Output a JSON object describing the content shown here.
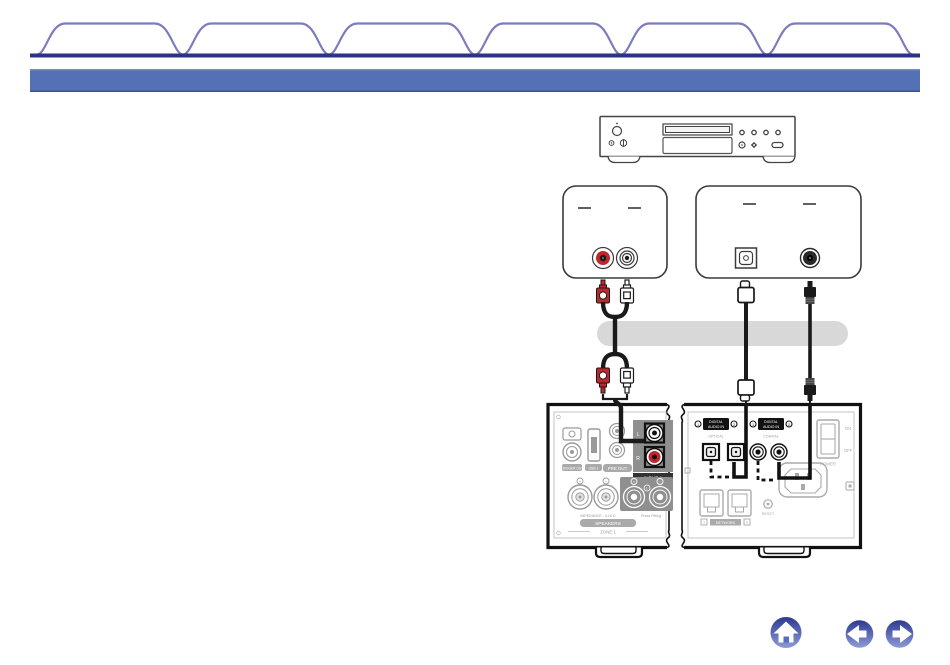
{
  "window": {
    "width": 950,
    "height": 665,
    "background": "#ffffff"
  },
  "tab_bar": {
    "outline_color": "#7b7bbd",
    "baseline_color": "#2b3383",
    "tabs": [
      {
        "label": ""
      },
      {
        "label": ""
      },
      {
        "label": ""
      },
      {
        "label": ""
      },
      {
        "label": ""
      },
      {
        "label": ""
      }
    ]
  },
  "title_bar": {
    "text": "",
    "background": "#5571b5"
  },
  "diagram": {
    "colors": {
      "line_art": "#3a3a3a",
      "deemphasized_gray": "#9a9a9a",
      "cable_black": "#1a1a1a",
      "rca_red": "#c0272d",
      "callout_pill_gray": "#d8d8d8",
      "highlight_black": "#111111"
    },
    "labels": {
      "pre_out": "PRE OUT",
      "input1": "INPUT 1",
      "jack_l": "L",
      "jack_r": "R",
      "trigger": "TRIGGER OUT",
      "usb": "USB 1",
      "impedance": "IMPEDANCE : 4-16 Ω",
      "fitting": "Press Fitting",
      "speakers": "SPEAKERS",
      "zone": "ZONE 1",
      "plus": "+",
      "minus": "−",
      "digital_badge_line1": "DIGITAL",
      "digital_badge_line2": "AUDIO IN",
      "optical_sub": "OPTICAL",
      "coaxial_sub": "COAXIAL",
      "n1": "1",
      "n2": "2",
      "network": "NETWORK",
      "reset": "RESET",
      "power_on": "ON",
      "power_off": "OFF",
      "power": "POWER"
    }
  },
  "nav": {
    "gradient_top": "#2c3a90",
    "gradient_bottom": "#8e9bd8",
    "buttons": [
      {
        "icon": "home-icon"
      },
      {
        "icon": "arrow-left-icon"
      },
      {
        "icon": "arrow-right-icon"
      }
    ]
  }
}
